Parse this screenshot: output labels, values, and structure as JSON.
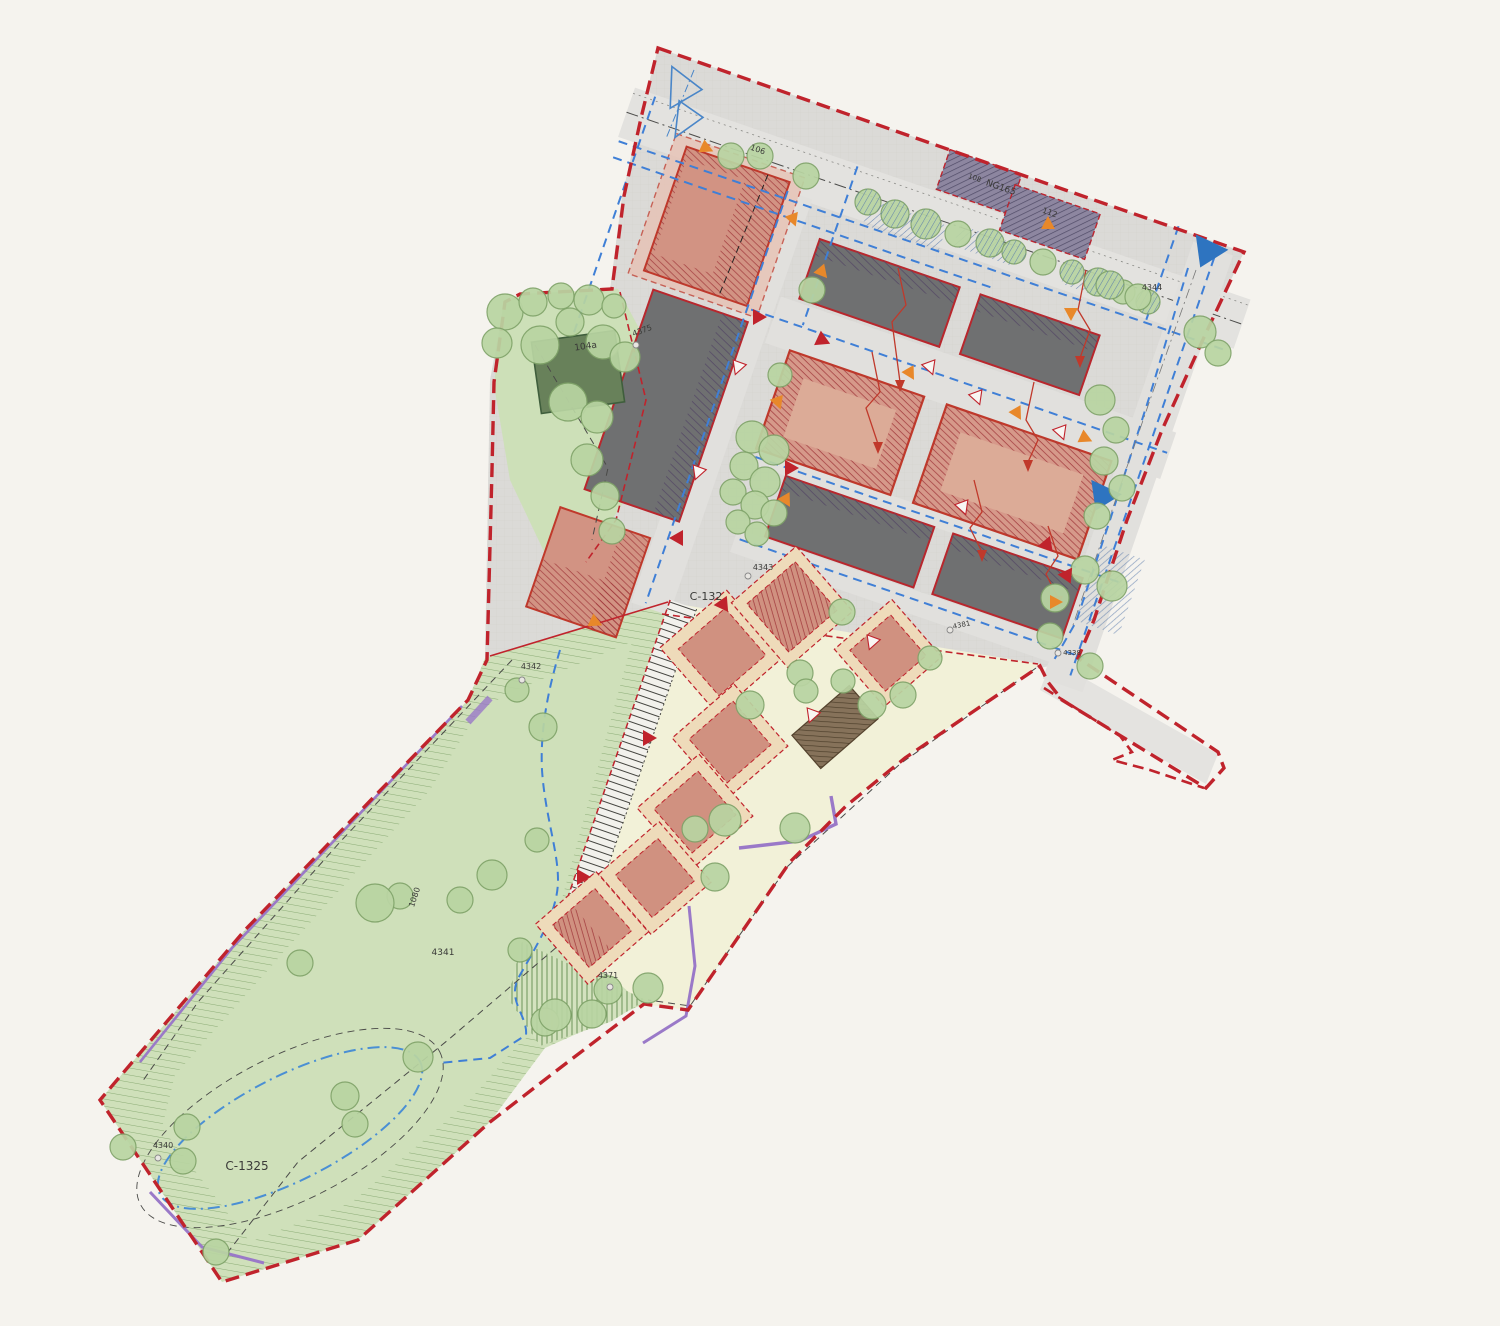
{
  "meta": {
    "drawing_type": "urban-site-plan"
  },
  "colors": {
    "background": "#f5f3ee",
    "paved_zone": "#dbdad7",
    "road": "#e3e2df",
    "boundary_red": "#c0232c",
    "building_dark": "#6f7071",
    "building_salmon": "#d29383",
    "building_salmon_light": "#dcab97",
    "building_existing_purple": "#8d86a0",
    "building_green_dark": "#68815a",
    "building_brown": "#86725a",
    "house_salmon": "#d09180",
    "plot_peach": "#eedbba",
    "yellow_area": "#f2f1d8",
    "green_strip": "#cfe0ba",
    "green_wedge": "#d4e2bf",
    "tree_fill": "#b9d4a2",
    "tree_stroke": "#7fa369",
    "blue_line": "#3f7fd6",
    "purple_line": "#9a79c8",
    "orange_marker": "#e8882a",
    "red_marker": "#c0232c",
    "label_color": "#3a3a38"
  },
  "labels": [
    {
      "id": "tree-106",
      "text": "106",
      "x": 757,
      "y": 152,
      "rot": 19,
      "size": 8
    },
    {
      "id": "road-ng165",
      "text": "NG165",
      "x": 1000,
      "y": 190,
      "rot": 19,
      "size": 9
    },
    {
      "id": "bldg-108",
      "text": "108",
      "x": 974,
      "y": 180,
      "rot": 19,
      "size": 7
    },
    {
      "id": "bldg-112",
      "text": "112",
      "x": 1049,
      "y": 215,
      "rot": 19,
      "size": 8
    },
    {
      "id": "parcel-4344",
      "text": "4344",
      "x": 1152,
      "y": 290,
      "rot": 0,
      "size": 8
    },
    {
      "id": "parcel-4375",
      "text": "4375",
      "x": 643,
      "y": 333,
      "rot": -20,
      "size": 8
    },
    {
      "id": "bldg-104a",
      "text": "104a",
      "x": 586,
      "y": 349,
      "rot": -8,
      "size": 9
    },
    {
      "id": "parcel-4343",
      "text": "4343",
      "x": 763,
      "y": 570,
      "rot": 0,
      "size": 8
    },
    {
      "id": "zone-c132",
      "text": "C-132",
      "x": 706,
      "y": 600,
      "rot": 0,
      "size": 11
    },
    {
      "id": "parcel-4381",
      "text": "4381",
      "x": 962,
      "y": 627,
      "rot": -12,
      "size": 7
    },
    {
      "id": "parcel-4338",
      "text": "4338",
      "x": 1072,
      "y": 655,
      "rot": 0,
      "size": 7
    },
    {
      "id": "parcel-4342",
      "text": "4342",
      "x": 531,
      "y": 669,
      "rot": 0,
      "size": 8
    },
    {
      "id": "parcel-4341",
      "text": "4341",
      "x": 443,
      "y": 955,
      "rot": 0,
      "size": 9
    },
    {
      "id": "parcel-1080",
      "text": "1080",
      "x": 417,
      "y": 898,
      "rot": -72,
      "size": 8
    },
    {
      "id": "parcel-4371",
      "text": "4371",
      "x": 608,
      "y": 978,
      "rot": 0,
      "size": 8
    },
    {
      "id": "parcel-4340",
      "text": "4340",
      "x": 163,
      "y": 1148,
      "rot": 0,
      "size": 8
    },
    {
      "id": "zone-c1325",
      "text": "C-1325",
      "x": 247,
      "y": 1170,
      "rot": 0,
      "size": 12
    }
  ],
  "trees": [
    [
      731,
      156,
      13,
      0
    ],
    [
      760,
      156,
      13,
      0
    ],
    [
      806,
      176,
      13,
      0
    ],
    [
      868,
      202,
      13,
      1
    ],
    [
      895,
      214,
      14,
      1
    ],
    [
      926,
      224,
      15,
      1
    ],
    [
      958,
      234,
      13,
      0
    ],
    [
      990,
      243,
      14,
      1
    ],
    [
      1014,
      252,
      12,
      1
    ],
    [
      1043,
      262,
      13,
      0
    ],
    [
      1072,
      272,
      12,
      1
    ],
    [
      1098,
      282,
      14,
      1
    ],
    [
      1123,
      292,
      12,
      0
    ],
    [
      1148,
      302,
      12,
      1
    ],
    [
      1200,
      332,
      16,
      0
    ],
    [
      1218,
      353,
      13,
      0
    ],
    [
      1110,
      285,
      14,
      1
    ],
    [
      1138,
      297,
      13,
      0
    ],
    [
      505,
      312,
      18,
      0
    ],
    [
      533,
      302,
      14,
      0
    ],
    [
      561,
      296,
      13,
      0
    ],
    [
      589,
      300,
      15,
      0
    ],
    [
      614,
      306,
      12,
      0
    ],
    [
      497,
      343,
      15,
      0
    ],
    [
      540,
      345,
      19,
      0
    ],
    [
      570,
      322,
      14,
      0
    ],
    [
      603,
      342,
      17,
      0
    ],
    [
      625,
      357,
      15,
      0
    ],
    [
      568,
      402,
      19,
      0
    ],
    [
      597,
      417,
      16,
      0
    ],
    [
      587,
      460,
      16,
      0
    ],
    [
      605,
      496,
      14,
      0
    ],
    [
      612,
      531,
      13,
      0
    ],
    [
      752,
      437,
      16,
      0
    ],
    [
      774,
      450,
      15,
      0
    ],
    [
      744,
      466,
      14,
      0
    ],
    [
      765,
      482,
      15,
      0
    ],
    [
      733,
      492,
      13,
      0
    ],
    [
      755,
      505,
      14,
      0
    ],
    [
      774,
      513,
      13,
      0
    ],
    [
      738,
      522,
      12,
      0
    ],
    [
      757,
      534,
      12,
      0
    ],
    [
      812,
      290,
      13,
      0
    ],
    [
      780,
      375,
      12,
      0
    ],
    [
      842,
      612,
      13,
      0
    ],
    [
      1100,
      400,
      15,
      0
    ],
    [
      1116,
      430,
      13,
      0
    ],
    [
      1104,
      461,
      14,
      0
    ],
    [
      1122,
      488,
      13,
      0
    ],
    [
      1097,
      516,
      13,
      0
    ],
    [
      1085,
      570,
      14,
      0
    ],
    [
      1112,
      586,
      15,
      0
    ],
    [
      1055,
      598,
      14,
      0
    ],
    [
      1050,
      636,
      13,
      0
    ],
    [
      1090,
      666,
      13,
      0
    ],
    [
      800,
      673,
      13,
      0
    ],
    [
      806,
      691,
      12,
      0
    ],
    [
      843,
      681,
      12,
      0
    ],
    [
      872,
      705,
      14,
      0
    ],
    [
      903,
      695,
      13,
      0
    ],
    [
      930,
      658,
      12,
      0
    ],
    [
      750,
      705,
      14,
      0
    ],
    [
      725,
      820,
      16,
      0
    ],
    [
      695,
      829,
      13,
      0
    ],
    [
      795,
      828,
      15,
      0
    ],
    [
      715,
      877,
      14,
      0
    ],
    [
      648,
      988,
      15,
      0
    ],
    [
      608,
      990,
      14,
      0
    ],
    [
      545,
      1022,
      14,
      0
    ],
    [
      517,
      690,
      12,
      0
    ],
    [
      543,
      727,
      14,
      0
    ],
    [
      537,
      840,
      12,
      0
    ],
    [
      492,
      875,
      15,
      0
    ],
    [
      460,
      900,
      13,
      0
    ],
    [
      400,
      896,
      13,
      0
    ],
    [
      375,
      903,
      19,
      0
    ],
    [
      300,
      963,
      13,
      0
    ],
    [
      345,
      1096,
      14,
      0
    ],
    [
      355,
      1124,
      13,
      0
    ],
    [
      187,
      1127,
      13,
      0
    ],
    [
      183,
      1161,
      13,
      0
    ],
    [
      123,
      1147,
      13,
      0
    ],
    [
      216,
      1252,
      13,
      0
    ],
    [
      418,
      1057,
      15,
      0
    ],
    [
      520,
      950,
      12,
      0
    ],
    [
      555,
      1015,
      16,
      0
    ],
    [
      592,
      1014,
      14,
      0
    ]
  ],
  "markers": {
    "orange_triangles": [
      [
        706,
        148,
        115
      ],
      [
        793,
        219,
        160
      ],
      [
        822,
        272,
        140
      ],
      [
        1048,
        224,
        0
      ],
      [
        1071,
        313,
        180
      ],
      [
        910,
        373,
        150
      ],
      [
        1017,
        413,
        150
      ],
      [
        1085,
        438,
        115
      ],
      [
        778,
        402,
        160
      ],
      [
        786,
        500,
        150
      ],
      [
        595,
        622,
        115
      ],
      [
        1055,
        602,
        90
      ]
    ],
    "red_triangles": [
      [
        758,
        317,
        90
      ],
      [
        822,
        340,
        115
      ],
      [
        790,
        468,
        90
      ],
      [
        678,
        538,
        270
      ],
      [
        1067,
        575,
        35
      ],
      [
        648,
        738,
        90
      ],
      [
        582,
        877,
        90
      ],
      [
        723,
        604,
        25
      ],
      [
        1047,
        545,
        140
      ]
    ],
    "outlined_triangles": [
      [
        738,
        367,
        200
      ],
      [
        698,
        472,
        200
      ],
      [
        930,
        367,
        160
      ],
      [
        977,
        397,
        160
      ],
      [
        1061,
        432,
        160
      ],
      [
        963,
        507,
        160
      ],
      [
        872,
        642,
        200
      ],
      [
        812,
        715,
        200
      ]
    ],
    "blue_solid_triangles": [
      [
        1207,
        253,
        205
      ],
      [
        1102,
        497,
        205
      ]
    ],
    "survey_circles": [
      [
        748,
        576
      ],
      [
        1058,
        653
      ],
      [
        522,
        680
      ],
      [
        610,
        987
      ],
      [
        158,
        1158
      ],
      [
        636,
        345
      ],
      [
        950,
        630
      ]
    ]
  },
  "houses": [
    [
      722,
      652,
      62,
      88,
      49,
      "new"
    ],
    [
      792,
      607,
      64,
      86,
      49,
      "hatched"
    ],
    [
      888,
      653,
      54,
      76,
      49,
      "new"
    ],
    [
      835,
      727,
      44,
      76,
      49,
      "brown"
    ],
    [
      730,
      742,
      58,
      82,
      49,
      "new"
    ],
    [
      695,
      812,
      58,
      82,
      49,
      "new"
    ],
    [
      655,
      878,
      56,
      80,
      49,
      "new"
    ],
    [
      592,
      928,
      56,
      80,
      49,
      "half"
    ]
  ]
}
